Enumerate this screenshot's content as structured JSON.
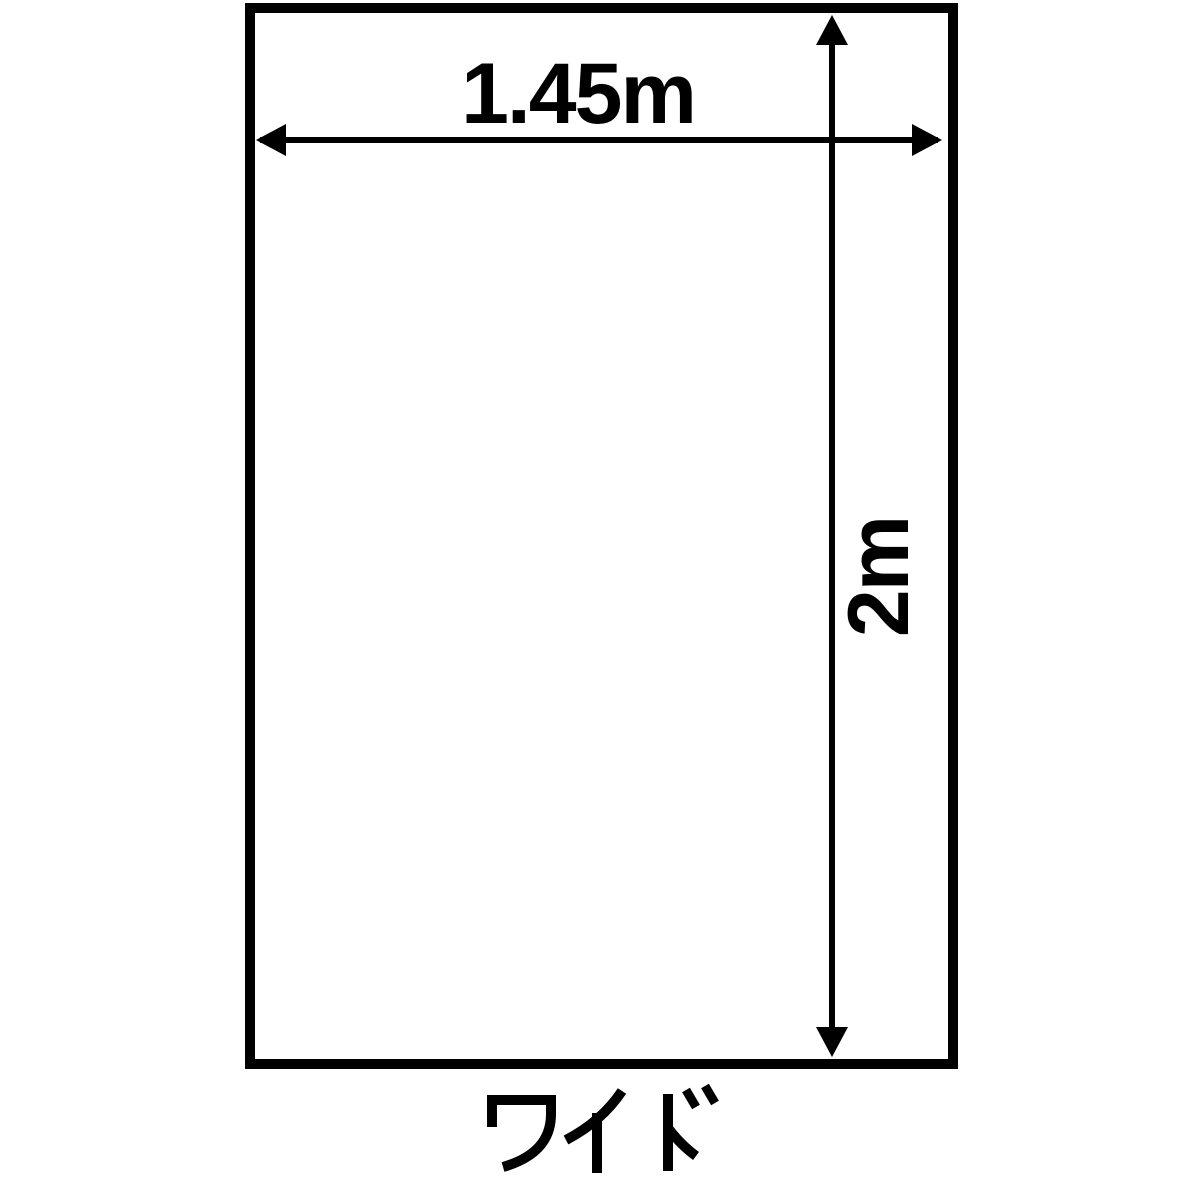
{
  "figure": {
    "type": "product-dimension-diagram",
    "shape": "rectangle-outline",
    "width_label": "1.45m",
    "height_label": "2m",
    "width_value": 1.45,
    "height_value": 2,
    "unit": "m",
    "caption": "ワイド",
    "caption_meaning": "Wide",
    "colors": {
      "line": "#000000",
      "background": "#ffffff"
    }
  }
}
